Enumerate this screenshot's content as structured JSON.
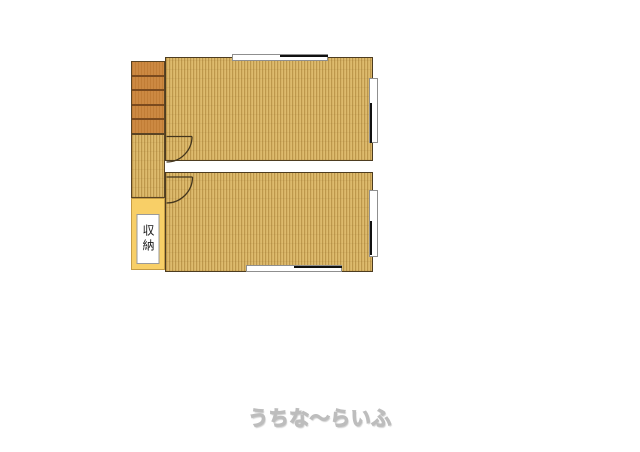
{
  "plan": {
    "type": "floor-plan",
    "storage": {
      "label": "収納",
      "fill": "#f8cf67"
    },
    "stairs": {
      "steps": 5,
      "fill": "#cc8942",
      "step_line": "#7a4a1e"
    },
    "rooms": [
      {
        "name": "upper-room",
        "flooring": "wood"
      },
      {
        "name": "lower-room",
        "flooring": "wood"
      }
    ],
    "colors": {
      "wood_base": "#d6b264",
      "wood_stripe": "#bd974b",
      "wall_outline": "#4d3c20",
      "window_frame": "#8f8f8f",
      "window_sash": "#111111"
    },
    "windows": [
      "top-wall",
      "right-wall-upper",
      "right-wall-lower",
      "bottom-wall"
    ],
    "doors": [
      "upper-room-door",
      "lower-room-door"
    ]
  },
  "watermark": {
    "text": "うちな～らいふ"
  }
}
